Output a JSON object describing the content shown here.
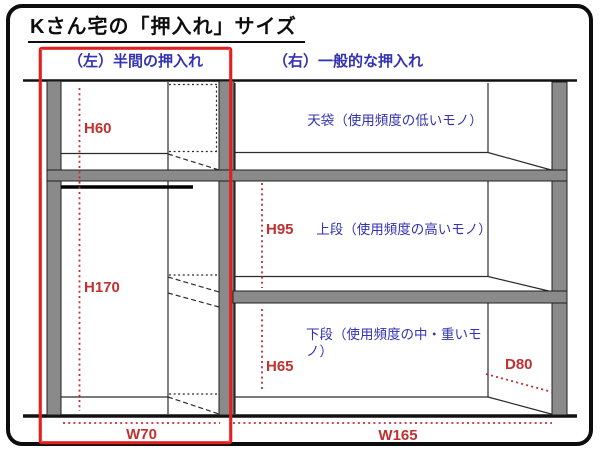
{
  "title": "Kさん宅の「押入れ」サイズ",
  "sections": {
    "left_label": "（左）半間の押入れ",
    "right_label": "（右）一般的な押入れ"
  },
  "compartments": {
    "tenbukuro": "天袋（使用頻度の低いモノ）",
    "jodan": "上段（使用頻度の高いモノ）",
    "gedan": "下段（使用頻度の中・重いモノ）"
  },
  "dimensions": {
    "left_top_height": "H60",
    "left_main_height": "H170",
    "left_width": "W70",
    "right_upper_height": "H95",
    "right_lower_height": "H65",
    "right_width": "W165",
    "depth": "D80"
  },
  "colors": {
    "label_blue": "#3333b3",
    "dimension_red": "#c23030",
    "highlight_red": "#e02020",
    "structure_gray": "#8a8a8a",
    "line_black": "#1a1a1a"
  }
}
